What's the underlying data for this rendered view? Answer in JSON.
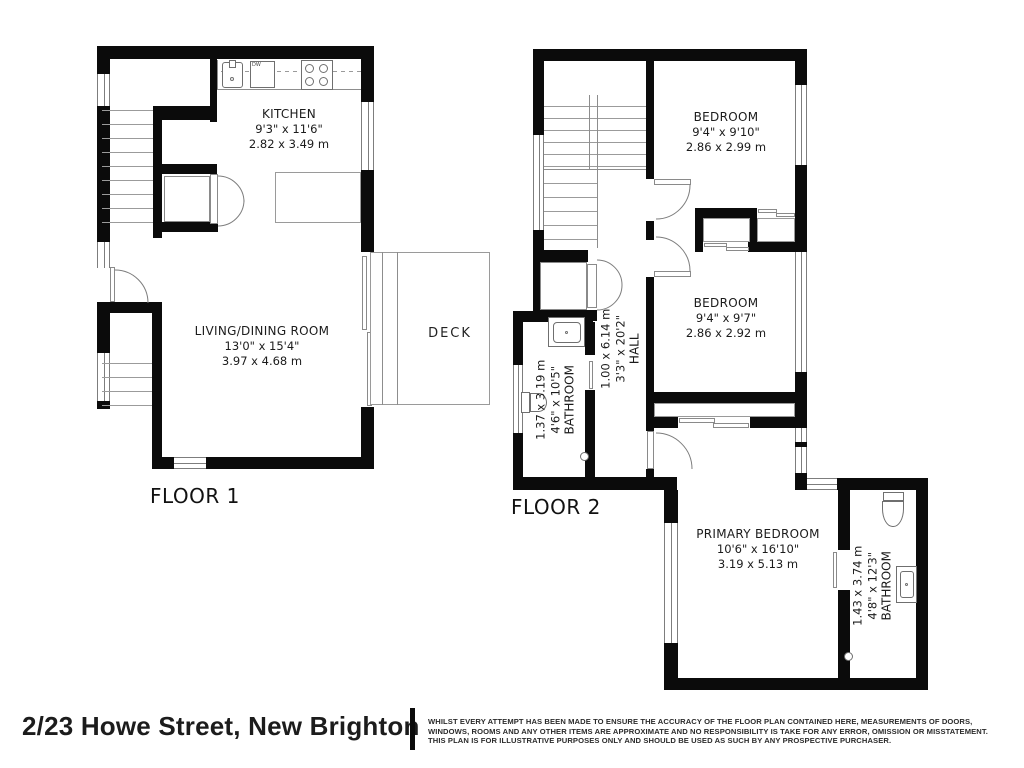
{
  "colors": {
    "wall": "#0b0b0b",
    "line": "#8d8d8d",
    "text": "#1b1b1b"
  },
  "floor1": {
    "label": "FLOOR 1",
    "rooms": {
      "kitchen": {
        "name": "KITCHEN",
        "imperial": "9'3\" x 11'6\"",
        "metric": "2.82 x 3.49 m"
      },
      "living": {
        "name": "LIVING/DINING ROOM",
        "imperial": "13'0\" x 15'4\"",
        "metric": "3.97 x 4.68 m"
      },
      "deck": {
        "name": "DECK"
      }
    },
    "appliances": {
      "dishwasher": "DW"
    }
  },
  "floor2": {
    "label": "FLOOR 2",
    "rooms": {
      "bedroom1": {
        "name": "BEDROOM",
        "imperial": "9'4\" x 9'10\"",
        "metric": "2.86 x 2.99 m"
      },
      "bedroom2": {
        "name": "BEDROOM",
        "imperial": "9'4\" x 9'7\"",
        "metric": "2.86 x 2.92 m"
      },
      "hall": {
        "name": "HALL",
        "imperial": "3'3\" x 20'2\"",
        "metric": "1.00 x 6.14 m"
      },
      "bathroom": {
        "name": "BATHROOM",
        "imperial": "4'6\" x 10'5\"",
        "metric": "1.37 x 3.19 m"
      },
      "primary": {
        "name": "PRIMARY BEDROOM",
        "imperial": "10'6\" x 16'10\"",
        "metric": "3.19 x 5.13 m"
      },
      "ensuite": {
        "name": "BATHROOM",
        "imperial": "4'8\" x 12'3\"",
        "metric": "1.43 x 3.74 m"
      }
    }
  },
  "footer": {
    "address": "2/23 Howe Street, New Brighton",
    "disclaimer": [
      "WHILST EVERY ATTEMPT HAS BEEN MADE TO ENSURE THE ACCURACY OF THE FLOOR PLAN CONTAINED HERE, MEASUREMENTS OF DOORS,",
      "WINDOWS, ROOMS AND ANY OTHER ITEMS ARE APPROXIMATE AND NO RESPONSIBILITY IS TAKE FOR ANY ERROR, OMISSION OR MISSTATEMENT.",
      "THIS PLAN IS FOR ILLUSTRATIVE PURPOSES ONLY AND SHOULD BE USED AS SUCH BY ANY PROSPECTIVE PURCHASER."
    ]
  }
}
